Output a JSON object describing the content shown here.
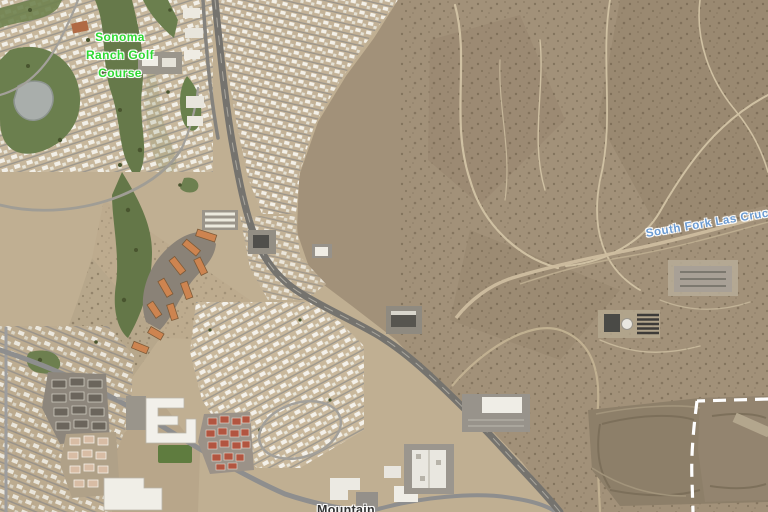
{
  "map": {
    "view_type": "satellite-imagery",
    "labels": {
      "golf_course": {
        "line1": "Sonoma",
        "line2": "Ranch Golf",
        "line3": "Course",
        "color": "#2fd832"
      },
      "arroyo": {
        "text": "South Fork Las Cruces Ar",
        "color": "#6b9bd2"
      },
      "street": {
        "text": "Mountain",
        "color": "#333333"
      }
    },
    "palette": {
      "desert": "#a29179",
      "developed_ground": "#c5b498",
      "golf_green": "#6b7f4e",
      "pond_gray": "#a9aeab",
      "road_gray": "#7d7b76",
      "apartment_roof_orange": "#cd8450",
      "townhouse_roof_red": "#b25540",
      "boundary_dash_white": "#ffffff"
    }
  }
}
